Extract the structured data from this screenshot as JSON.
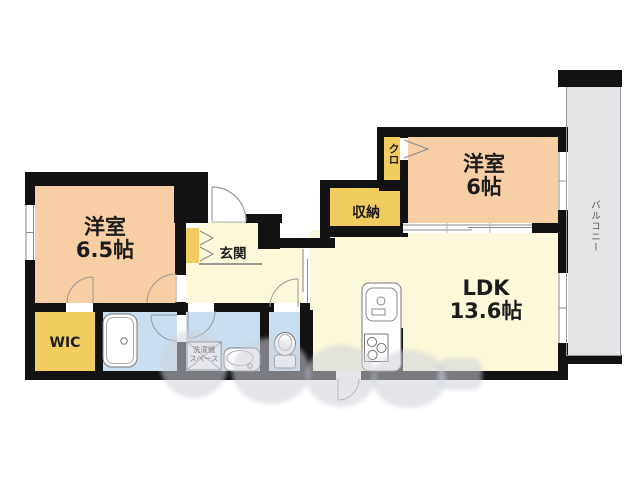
{
  "floorplan": {
    "rooms": {
      "west_room_1": {
        "label": "洋室",
        "size": "6.5帖"
      },
      "west_room_2": {
        "label": "洋室",
        "size": "6帖"
      },
      "ldk": {
        "label": "LDK",
        "size": "13.6帖"
      },
      "wic": {
        "label": "WIC"
      },
      "entrance": {
        "label": "玄関"
      },
      "storage": {
        "label": "収納"
      },
      "closet": {
        "label": "クロ"
      },
      "balcony": {
        "label": "バルコニー"
      },
      "laundry": {
        "line1": "洗濯機",
        "line2": "スペース"
      }
    },
    "colors": {
      "wall": "#121212",
      "room_peach": "#f8cea4",
      "room_cream": "#fcf8da",
      "wet_blue": "#c7dff0",
      "storage_yellow": "#f3cc5f",
      "balcony_gray": "#e4e4e7",
      "background": "#ffffff"
    }
  }
}
